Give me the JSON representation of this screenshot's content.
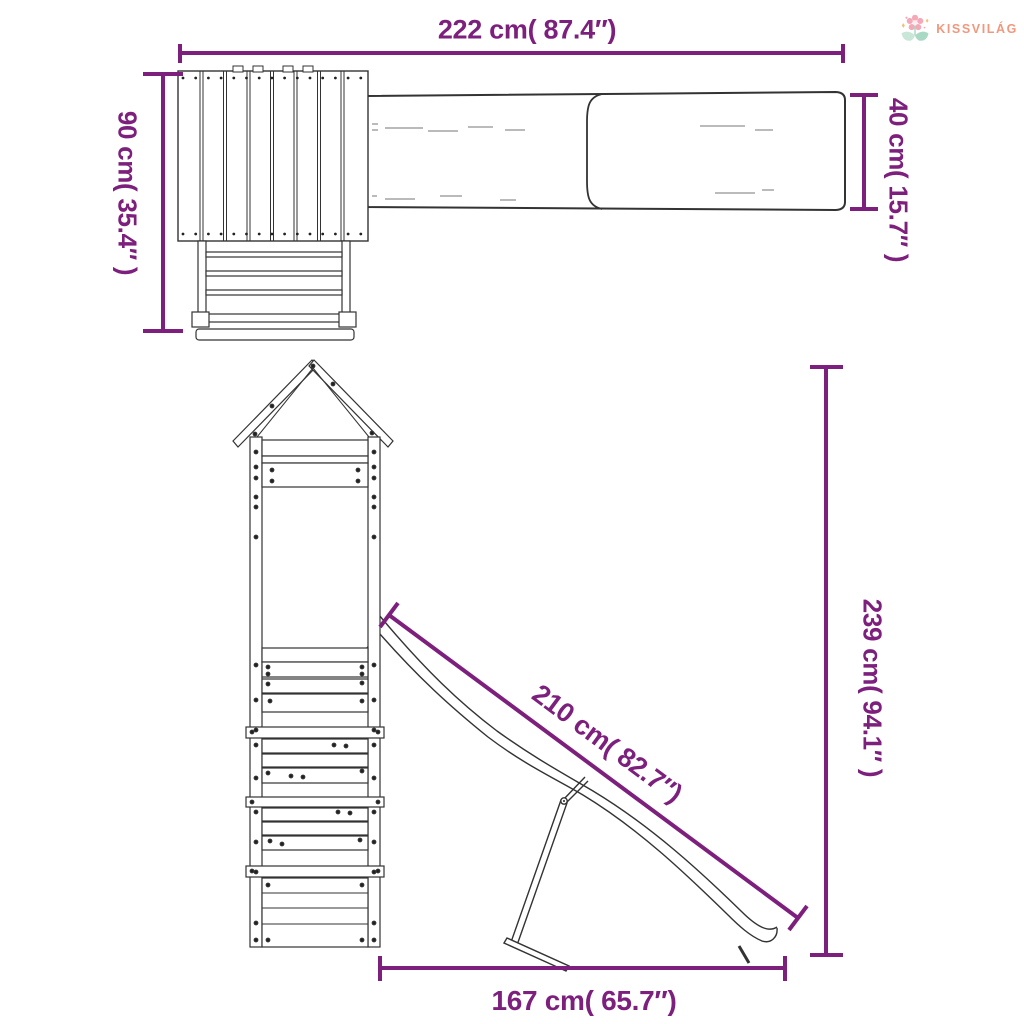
{
  "background": "#ffffff",
  "brand": {
    "name": "KISSVILÁG",
    "text_color": "#F0987E",
    "flower_icon": {
      "petal_color": "#F5A8B8",
      "center_color": "#FDEDF0",
      "leaf_color_left": "#C9E7D9",
      "leaf_color_right": "#A9D9C5",
      "sparkle_color": "#F6BE6F"
    }
  },
  "drawing": {
    "accent_color": "#7D207D",
    "line_color": "#333333",
    "dimensions": {
      "width_total": {
        "label": "222 cm( 87.4″)",
        "cm": 222,
        "inch": 87.4
      },
      "depth": {
        "label": "90 cm( 35.4″ )",
        "cm": 90,
        "inch": 35.4
      },
      "slide_width": {
        "label": "40 cm( 15.7″ )",
        "cm": 40,
        "inch": 15.7
      },
      "height": {
        "label": "239 cm( 94.1″ )",
        "cm": 239,
        "inch": 94.1
      },
      "slide_length": {
        "label": "210 cm( 82.7″)",
        "cm": 210,
        "inch": 82.7
      },
      "ground_length": {
        "label": "167 cm( 65.7″)",
        "cm": 167,
        "inch": 65.7
      }
    }
  }
}
